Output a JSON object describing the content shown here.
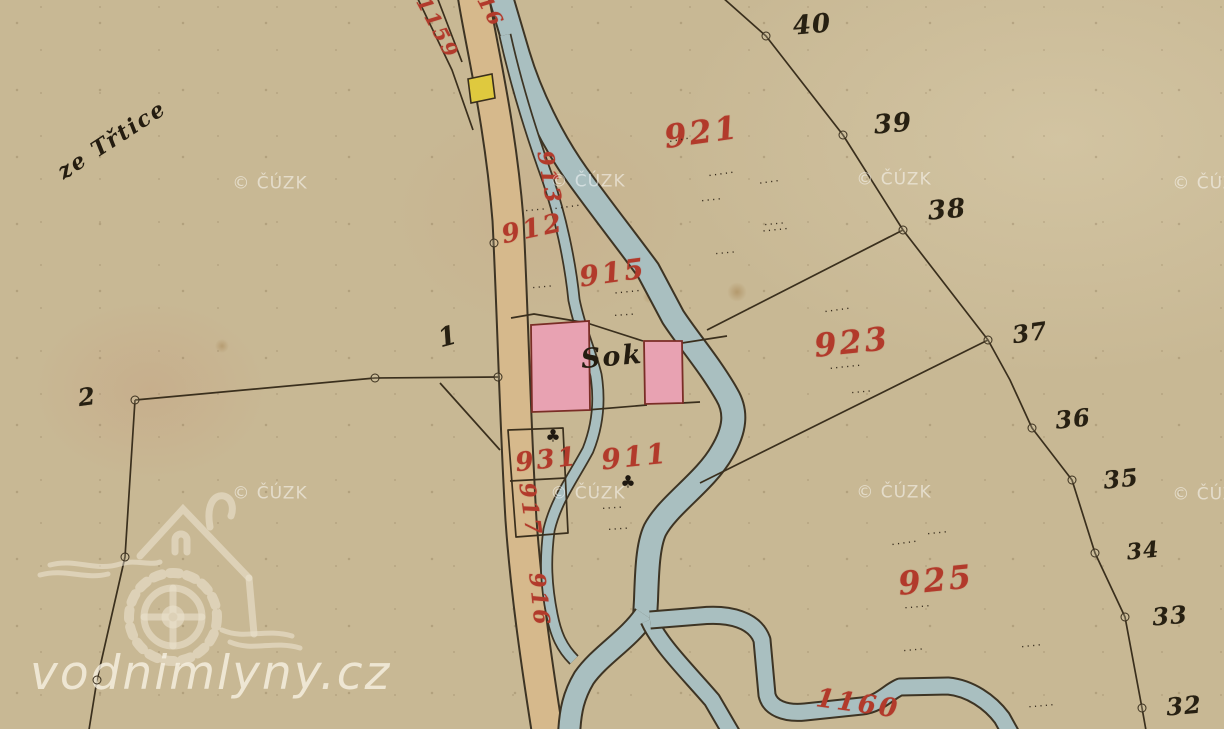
{
  "site_watermark": {
    "text": "vodnimlyny.cz"
  },
  "colors": {
    "paper": "#c8b894",
    "road": "#d6b98c",
    "water": "#a9bfc0",
    "building_pink": "#e8a2b2",
    "building_yellow": "#dfc93e",
    "ink": "#3a2f1d",
    "parcel_red": "#b23a2b",
    "watermark": "rgba(255,255,255,0.5)"
  },
  "layers": [
    {
      "name": "red-parcel-number",
      "cls": "num-red",
      "items": [
        {
          "t": "1159",
          "x": 438,
          "y": 28,
          "r": 62,
          "s": 20
        },
        {
          "t": "916",
          "x": 487,
          "y": 4,
          "r": 62,
          "s": 20
        },
        {
          "t": "913",
          "x": 549,
          "y": 178,
          "r": 80,
          "s": 22
        },
        {
          "t": "912",
          "x": 533,
          "y": 229,
          "r": -12,
          "s": 26
        },
        {
          "t": "915",
          "x": 613,
          "y": 273,
          "r": -8,
          "s": 28
        },
        {
          "t": "921",
          "x": 702,
          "y": 132,
          "r": -8,
          "s": 32
        },
        {
          "t": "923",
          "x": 852,
          "y": 342,
          "r": -6,
          "s": 32
        },
        {
          "t": "931",
          "x": 547,
          "y": 460,
          "r": -6,
          "s": 26
        },
        {
          "t": "911",
          "x": 635,
          "y": 457,
          "r": -6,
          "s": 28
        },
        {
          "t": "917",
          "x": 530,
          "y": 510,
          "r": 82,
          "s": 22
        },
        {
          "t": "916",
          "x": 539,
          "y": 600,
          "r": 84,
          "s": 22
        },
        {
          "t": "925",
          "x": 936,
          "y": 580,
          "r": -6,
          "s": 32
        },
        {
          "t": "1160",
          "x": 858,
          "y": 704,
          "r": 8,
          "s": 26
        }
      ]
    },
    {
      "name": "black-boundary-number",
      "cls": "num-black",
      "items": [
        {
          "t": "40",
          "x": 812,
          "y": 25,
          "r": -5,
          "s": 26
        },
        {
          "t": "39",
          "x": 893,
          "y": 124,
          "r": -5,
          "s": 26
        },
        {
          "t": "38",
          "x": 947,
          "y": 210,
          "r": -5,
          "s": 26
        },
        {
          "t": "37",
          "x": 1030,
          "y": 333,
          "r": -8,
          "s": 24
        },
        {
          "t": "36",
          "x": 1073,
          "y": 419,
          "r": -6,
          "s": 24
        },
        {
          "t": "35",
          "x": 1121,
          "y": 479,
          "r": -6,
          "s": 24
        },
        {
          "t": "34",
          "x": 1143,
          "y": 551,
          "r": -6,
          "s": 22
        },
        {
          "t": "33",
          "x": 1170,
          "y": 616,
          "r": -5,
          "s": 24
        },
        {
          "t": "32",
          "x": 1184,
          "y": 706,
          "r": -5,
          "s": 24
        },
        {
          "t": "1",
          "x": 448,
          "y": 337,
          "r": -15,
          "s": 26
        },
        {
          "t": "2",
          "x": 87,
          "y": 397,
          "r": -8,
          "s": 24
        }
      ]
    },
    {
      "name": "house-label",
      "cls": "ink-label",
      "items": [
        {
          "t": "Sok",
          "x": 612,
          "y": 357,
          "r": -5,
          "s": 27
        }
      ]
    },
    {
      "name": "region-label",
      "cls": "ink-label",
      "items": [
        {
          "t": "ze Třtice",
          "x": 112,
          "y": 140,
          "r": -33,
          "s": 22
        }
      ]
    },
    {
      "name": "cuzk-watermark",
      "cls": "cuzk",
      "items": [
        {
          "t": "© ČÚZK",
          "x": 270,
          "y": 184
        },
        {
          "t": "© ČÚZK",
          "x": 588,
          "y": 182
        },
        {
          "t": "© ČÚZK",
          "x": 894,
          "y": 180
        },
        {
          "t": "© ČÚZK",
          "x": 1210,
          "y": 184
        },
        {
          "t": "© ČÚZK",
          "x": 270,
          "y": 494
        },
        {
          "t": "© ČÚZK",
          "x": 588,
          "y": 494
        },
        {
          "t": "© ČÚZK",
          "x": 894,
          "y": 493
        },
        {
          "t": "© ČÚZK",
          "x": 1210,
          "y": 495
        }
      ]
    },
    {
      "name": "field-dots",
      "cls": "dots",
      "items": [
        {
          "t": "·····",
          "x": 568,
          "y": 207,
          "r": -8
        },
        {
          "t": "····",
          "x": 536,
          "y": 210,
          "r": -5
        },
        {
          "t": "····",
          "x": 543,
          "y": 287,
          "r": -5
        },
        {
          "t": "·····",
          "x": 628,
          "y": 292,
          "r": -6
        },
        {
          "t": "····",
          "x": 625,
          "y": 315,
          "r": -4
        },
        {
          "t": "····",
          "x": 680,
          "y": 140,
          "r": -10
        },
        {
          "t": "·····",
          "x": 722,
          "y": 174,
          "r": -8
        },
        {
          "t": "····",
          "x": 712,
          "y": 200,
          "r": -6
        },
        {
          "t": "····",
          "x": 770,
          "y": 182,
          "r": -8
        },
        {
          "t": "·····",
          "x": 776,
          "y": 230,
          "r": -6
        },
        {
          "t": "····",
          "x": 726,
          "y": 253,
          "r": -5
        },
        {
          "t": "····",
          "x": 775,
          "y": 224,
          "r": -5
        },
        {
          "t": "·····",
          "x": 838,
          "y": 310,
          "r": -8
        },
        {
          "t": "······",
          "x": 846,
          "y": 367,
          "r": -6
        },
        {
          "t": "····",
          "x": 862,
          "y": 392,
          "r": -5
        },
        {
          "t": "·····",
          "x": 905,
          "y": 543,
          "r": -8
        },
        {
          "t": "····",
          "x": 938,
          "y": 533,
          "r": -6
        },
        {
          "t": "·····",
          "x": 918,
          "y": 607,
          "r": -5
        },
        {
          "t": "····",
          "x": 613,
          "y": 508,
          "r": -4
        },
        {
          "t": "····",
          "x": 619,
          "y": 529,
          "r": -4
        },
        {
          "t": "····",
          "x": 914,
          "y": 650,
          "r": -5
        },
        {
          "t": "····",
          "x": 1032,
          "y": 646,
          "r": -6
        },
        {
          "t": "·····",
          "x": 1042,
          "y": 706,
          "r": -5
        }
      ]
    },
    {
      "name": "tree-symbol",
      "cls": "tree",
      "items": [
        {
          "t": "♣",
          "x": 553,
          "y": 437
        },
        {
          "t": "♣",
          "x": 628,
          "y": 483
        }
      ]
    },
    {
      "name": "survey-point",
      "cls": "survey",
      "items": [
        {
          "x": 766,
          "y": 36
        },
        {
          "x": 843,
          "y": 135
        },
        {
          "x": 903,
          "y": 230
        },
        {
          "x": 988,
          "y": 340
        },
        {
          "x": 1032,
          "y": 428
        },
        {
          "x": 1072,
          "y": 480
        },
        {
          "x": 1095,
          "y": 553
        },
        {
          "x": 1125,
          "y": 617
        },
        {
          "x": 1142,
          "y": 708
        },
        {
          "x": 135,
          "y": 400
        },
        {
          "x": 375,
          "y": 378
        },
        {
          "x": 498,
          "y": 377
        },
        {
          "x": 494,
          "y": 243
        },
        {
          "x": 125,
          "y": 557
        },
        {
          "x": 97,
          "y": 680
        }
      ]
    }
  ]
}
